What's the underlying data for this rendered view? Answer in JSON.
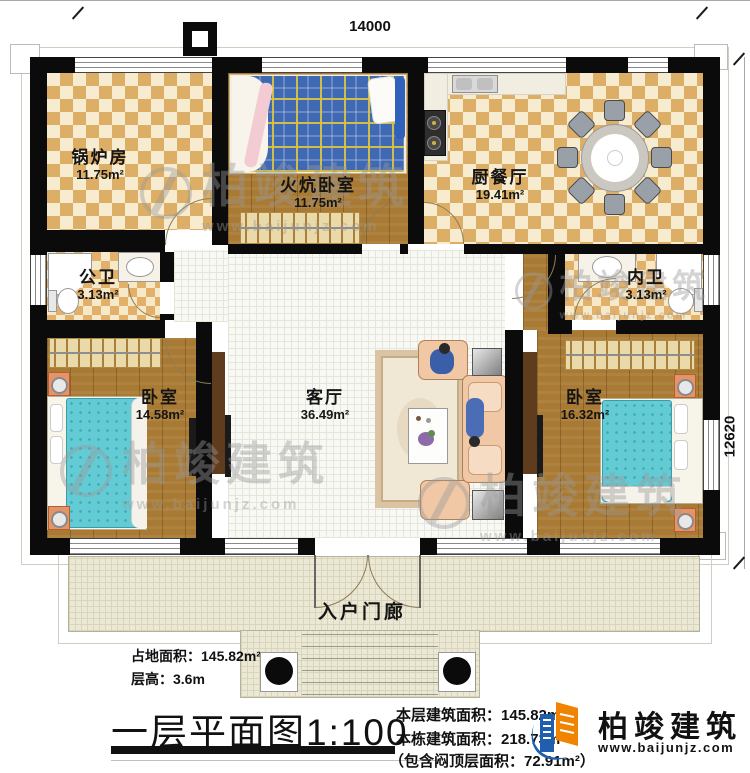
{
  "title": {
    "main": "一层平面图",
    "scale": "1:100"
  },
  "dimensions": {
    "top": "14000",
    "right": "12620"
  },
  "rooms": {
    "boiler": {
      "name": "锅炉房",
      "area": "11.75m²"
    },
    "kang": {
      "name": "火炕卧室",
      "area": "11.75m²"
    },
    "kitchen": {
      "name": "厨餐厅",
      "area": "19.41m²"
    },
    "bath1": {
      "name": "公卫",
      "area": "3.13m²"
    },
    "bath2": {
      "name": "内卫",
      "area": "3.13m²"
    },
    "bed1": {
      "name": "卧室",
      "area": "14.58m²"
    },
    "living": {
      "name": "客厅",
      "area": "36.49m²"
    },
    "bed2": {
      "name": "卧室",
      "area": "16.32m²"
    },
    "porch": {
      "name": "入户门廊"
    }
  },
  "stats_left": [
    {
      "label": "占地面积：",
      "value": "145.82m²"
    },
    {
      "label": "层高：",
      "value": "3.6m"
    }
  ],
  "stats_right": [
    {
      "label": "本层建筑面积：",
      "value": "145.82m²"
    },
    {
      "label": "本栋建筑面积：",
      "value": "218.73m²"
    },
    {
      "label": "（包含闷顶层面积：",
      "value": "72.91m²）"
    }
  ],
  "brand": {
    "name": "柏竣建筑",
    "url": "www.baijunjz.com"
  },
  "watermark": {
    "name": "柏竣建筑",
    "url": "www.baijunjz.com"
  }
}
